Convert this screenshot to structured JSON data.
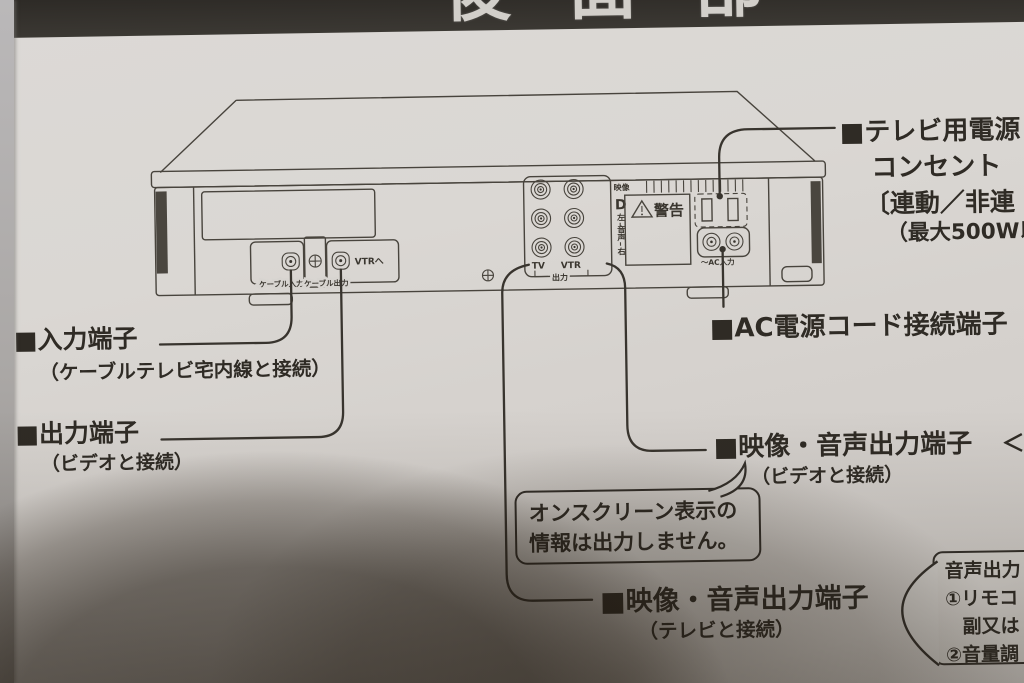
{
  "banner": {
    "title_fragment": "後面部"
  },
  "diagram": {
    "cable_input": "ケーブル入力",
    "cable_output": "ケーブル出力",
    "to_vtr": "VTRへ",
    "tv": "TV",
    "vtr": "VTR",
    "output": "出力",
    "video": "映像",
    "bracket": "D",
    "left": "左",
    "audio_1": "音",
    "audio_2": "声",
    "right": "右",
    "warning": "警告",
    "ac_input": "〜AC入力"
  },
  "callouts": {
    "input": {
      "title": "■入力端子",
      "sub": "（ケーブルテレビ宅内線と接続）"
    },
    "output": {
      "title": "■出力端子",
      "sub": "（ビデオと接続）"
    },
    "tv_power": {
      "line1": "■テレビ用電源",
      "line2": "コンセント",
      "line3": "〔連動／非連",
      "line4": "（最大500W以"
    },
    "ac_power": {
      "title": "■AC電源コード接続端子"
    },
    "av_out_video": {
      "title": "■映像・音声出力端子",
      "arrow": "＜",
      "sub": "（ビデオと接続）"
    },
    "av_out_tv": {
      "title": "■映像・音声出力端子",
      "sub": "（テレビと接続）"
    },
    "onscreen_note": {
      "line1": "オンスクリーン表示の",
      "line2": "情報は出力しません。"
    },
    "audio_note": {
      "line1": "音声出力",
      "line2": "①リモコ",
      "line3": "副又は",
      "line4": "②音量調"
    }
  }
}
